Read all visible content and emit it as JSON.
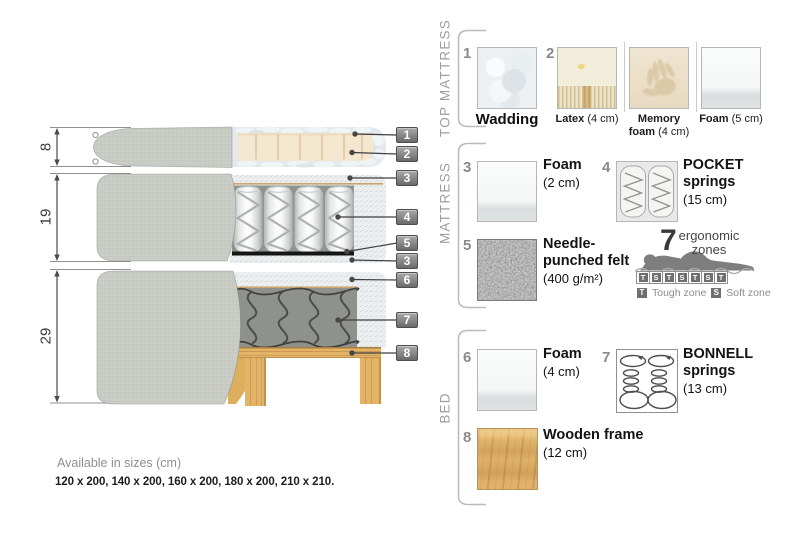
{
  "diagram": {
    "dimensions": [
      "8",
      "19",
      "29"
    ],
    "callouts": [
      "1",
      "2",
      "3",
      "4",
      "5",
      "3",
      "6",
      "7",
      "8"
    ]
  },
  "panel": {
    "top_mattress": {
      "title": "TOP MATTRESS",
      "wadding": {
        "num": "1",
        "name": "Wadding"
      },
      "latex": {
        "num": "2",
        "name": "Latex",
        "size": "(4 cm)"
      },
      "memory_foam": {
        "name": "Memory foam",
        "size": "(4 cm)"
      },
      "foam": {
        "name": "Foam",
        "size": "(5 cm)"
      }
    },
    "mattress": {
      "title": "MATTRESS",
      "foam": {
        "num": "3",
        "name": "Foam",
        "size": "(2 cm)"
      },
      "pocket_springs": {
        "num": "4",
        "name": "POCKET springs",
        "size": "(15 cm)"
      },
      "felt": {
        "num": "5",
        "name": "Needle-punched felt",
        "size": "(400 g/m²)"
      },
      "ergonomic": {
        "number": "7",
        "label": "ergonomic zones",
        "zones": [
          "T",
          "S",
          "T",
          "S",
          "T",
          "S",
          "T"
        ],
        "legend": [
          {
            "key": "T",
            "label": "Tough zone"
          },
          {
            "key": "S",
            "label": "Soft zone"
          }
        ]
      }
    },
    "bed": {
      "title": "BED",
      "foam": {
        "num": "6",
        "name": "Foam",
        "size": "(4 cm)"
      },
      "bonnell_springs": {
        "num": "7",
        "name": "BONNELL springs",
        "size": "(13 cm)"
      },
      "wooden_frame": {
        "num": "8",
        "name": "Wooden frame",
        "size": "(12 cm)"
      }
    }
  },
  "footer": {
    "availability": "Available in sizes (cm)",
    "sizes": "120 x 200, 140 x 200, 160 x 200, 180 x 200, 210 x 210."
  },
  "colors": {
    "wood": "#e0b169",
    "cover": "#c9ccc5",
    "felt": "#5a5a5a",
    "badge": "#6a6a6a"
  }
}
